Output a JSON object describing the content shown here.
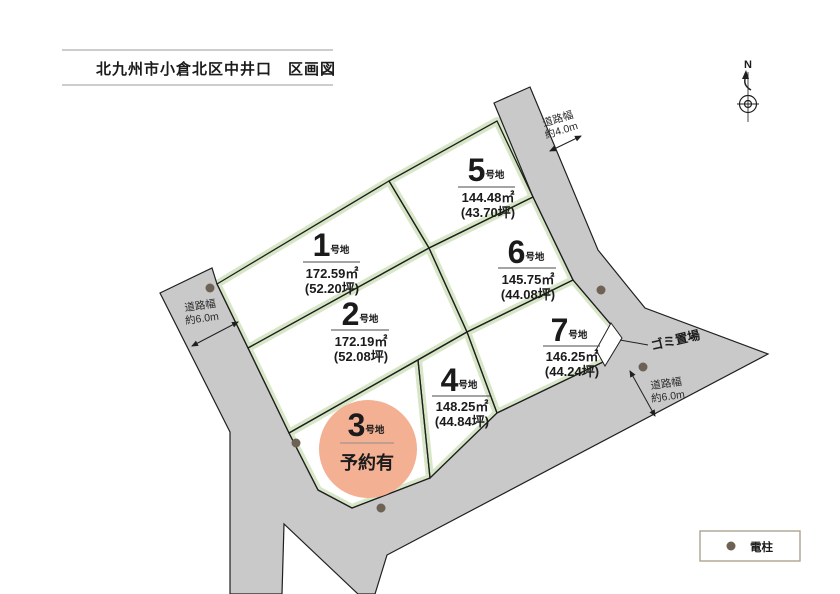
{
  "title": "北九州市小倉北区中井口　区画図",
  "compass": {
    "label": "N"
  },
  "plots": [
    {
      "num": "1",
      "suffix": "号地",
      "area": "172.59㎡",
      "tsubo": "(52.20坪)"
    },
    {
      "num": "2",
      "suffix": "号地",
      "area": "172.19㎡",
      "tsubo": "(52.08坪)"
    },
    {
      "num": "3",
      "suffix": "号地",
      "status": "予約有"
    },
    {
      "num": "4",
      "suffix": "号地",
      "area": "148.25㎡",
      "tsubo": "(44.84坪)"
    },
    {
      "num": "5",
      "suffix": "号地",
      "area": "144.48㎡",
      "tsubo": "(43.70坪)"
    },
    {
      "num": "6",
      "suffix": "号地",
      "area": "145.75㎡",
      "tsubo": "(44.08坪)"
    },
    {
      "num": "7",
      "suffix": "号地",
      "area": "146.25㎡",
      "tsubo": "(44.24坪)"
    }
  ],
  "road_labels": {
    "top_right": {
      "l1": "道路幅",
      "l2": "約4.0m"
    },
    "left": {
      "l1": "道路幅",
      "l2": "約6.0m"
    },
    "bottom_right": {
      "l1": "道路幅",
      "l2": "約6.0m"
    }
  },
  "garbage": {
    "label": "ゴミ置場"
  },
  "legend": {
    "symbol": "●",
    "label": "電柱"
  },
  "colors": {
    "road_fill": "#c9c9c9",
    "plot_edge_green": "#d7e6c6",
    "outline": "#1f1f1f",
    "reserved_circle": "#f3b093",
    "pole_dot": "#6e6254",
    "legend_border": "#b3a995"
  }
}
